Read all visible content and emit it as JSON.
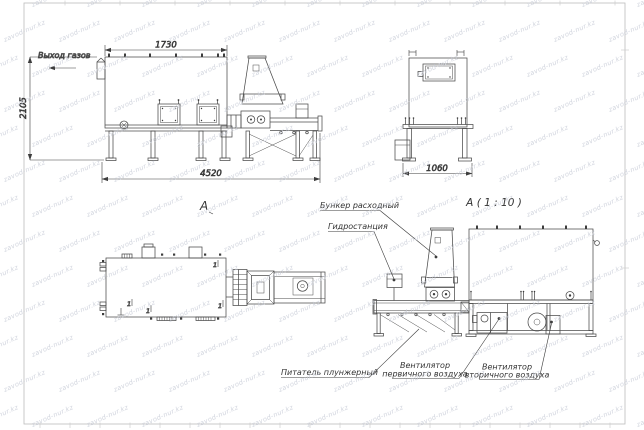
{
  "sheet": {
    "view_side": {
      "gas_outlet_label": "Выход газов",
      "dim_width_top": "1730",
      "dim_height_left": "2105",
      "dim_width_bottom": "4520",
      "view_label": "А"
    },
    "view_front": {
      "dim_width_bottom": "1060"
    },
    "view_plan": {
      "position_mark": "1"
    },
    "view_detail": {
      "title": "А ( 1 : 10 )",
      "callout_hopper": "Бункер расходный",
      "callout_hydraulic": "Гидростанция",
      "callout_feeder": "Питатель плунжерный",
      "callout_fan_primary_line1": "Вентилятор",
      "callout_fan_primary_line2": "первичного воздуха",
      "callout_fan_secondary_line1": "Вентилятор",
      "callout_fan_secondary_line2": "вторичного воздуха"
    }
  },
  "watermark": {
    "text": "zavod-nur.kz",
    "color": "#c9cdd8",
    "rows": 13,
    "cols": 13
  },
  "colors": {
    "line": "#4b4b4b",
    "dim_text": "#333333",
    "frame": "#bdbdbd",
    "background": "#ffffff"
  }
}
